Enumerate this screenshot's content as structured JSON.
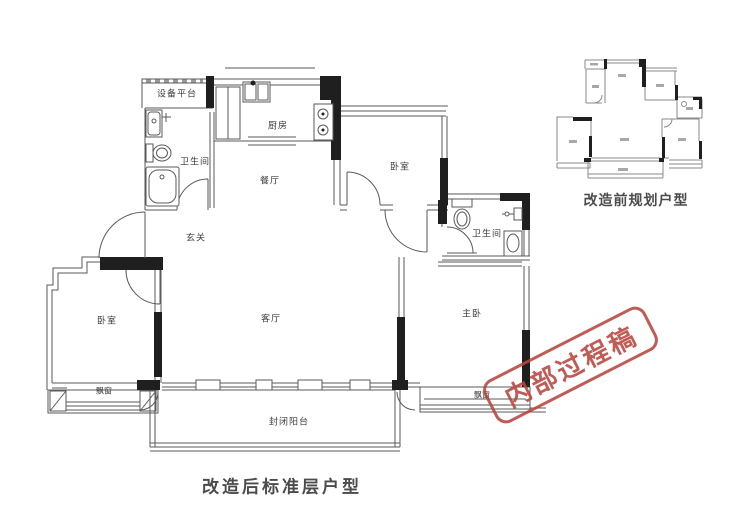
{
  "main_plan": {
    "caption": "改造后标准层户型",
    "rooms": [
      {
        "name": "equipment-platform",
        "label": "设备平台"
      },
      {
        "name": "bathroom-left",
        "label": "卫生间"
      },
      {
        "name": "kitchen",
        "label": "厨房"
      },
      {
        "name": "dining-room",
        "label": "餐厅"
      },
      {
        "name": "bedroom-top",
        "label": "卧室"
      },
      {
        "name": "foyer",
        "label": "玄关"
      },
      {
        "name": "bathroom-right",
        "label": "卫生间"
      },
      {
        "name": "bedroom-left",
        "label": "卧室"
      },
      {
        "name": "living-room",
        "label": "客厅"
      },
      {
        "name": "master-bedroom",
        "label": "主卧"
      },
      {
        "name": "bay-window-left",
        "label": "飘窗"
      },
      {
        "name": "bay-window-right",
        "label": "飘窗"
      },
      {
        "name": "enclosed-balcony",
        "label": "封闭阳台"
      }
    ]
  },
  "mini_plan": {
    "caption": "改造前规划户型"
  },
  "stamp": {
    "text": "内部过程稿"
  },
  "colors": {
    "wall_black": "#1f1f1f",
    "line_gray": "#5a5a5a",
    "stamp_red": "#b9453e",
    "label_gray": "#3c3c3c",
    "caption_gray": "#4b4b4b",
    "background": "#ffffff"
  }
}
